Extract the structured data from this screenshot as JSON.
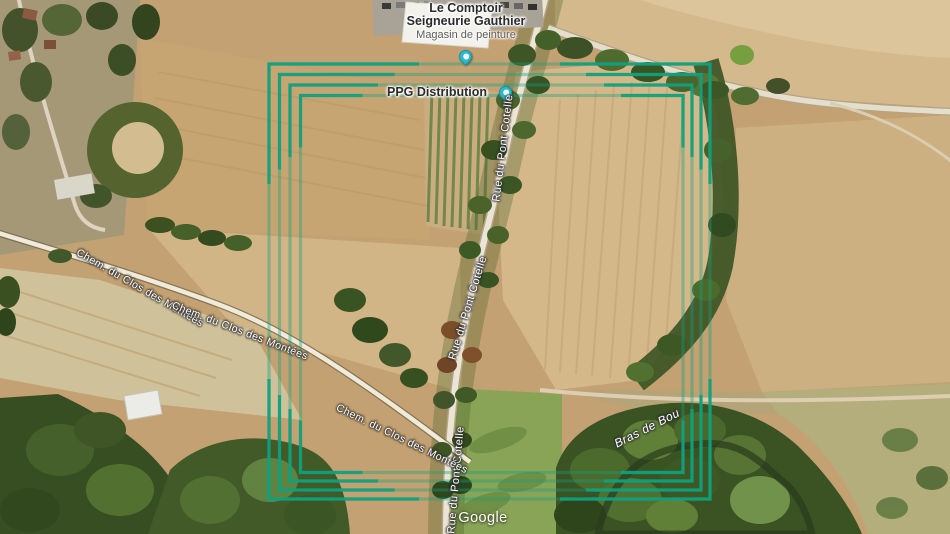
{
  "map": {
    "attribution": "Google",
    "pois": [
      {
        "title": "Le Comptoir Seigneurie Gauthier",
        "subtitle": "Magasin de peinture"
      },
      {
        "title": "PPG Distribution"
      }
    ],
    "roads": {
      "rue_du_pont": "Rue du Pont Cotelle",
      "chemin": "Chem. du Clos des Montées",
      "stream": "Bras de Bou"
    },
    "overlay": {
      "shape": "nested-rectangles",
      "rings": 4,
      "color": "#0fa17e"
    },
    "pin_color": "#31b7c9"
  }
}
